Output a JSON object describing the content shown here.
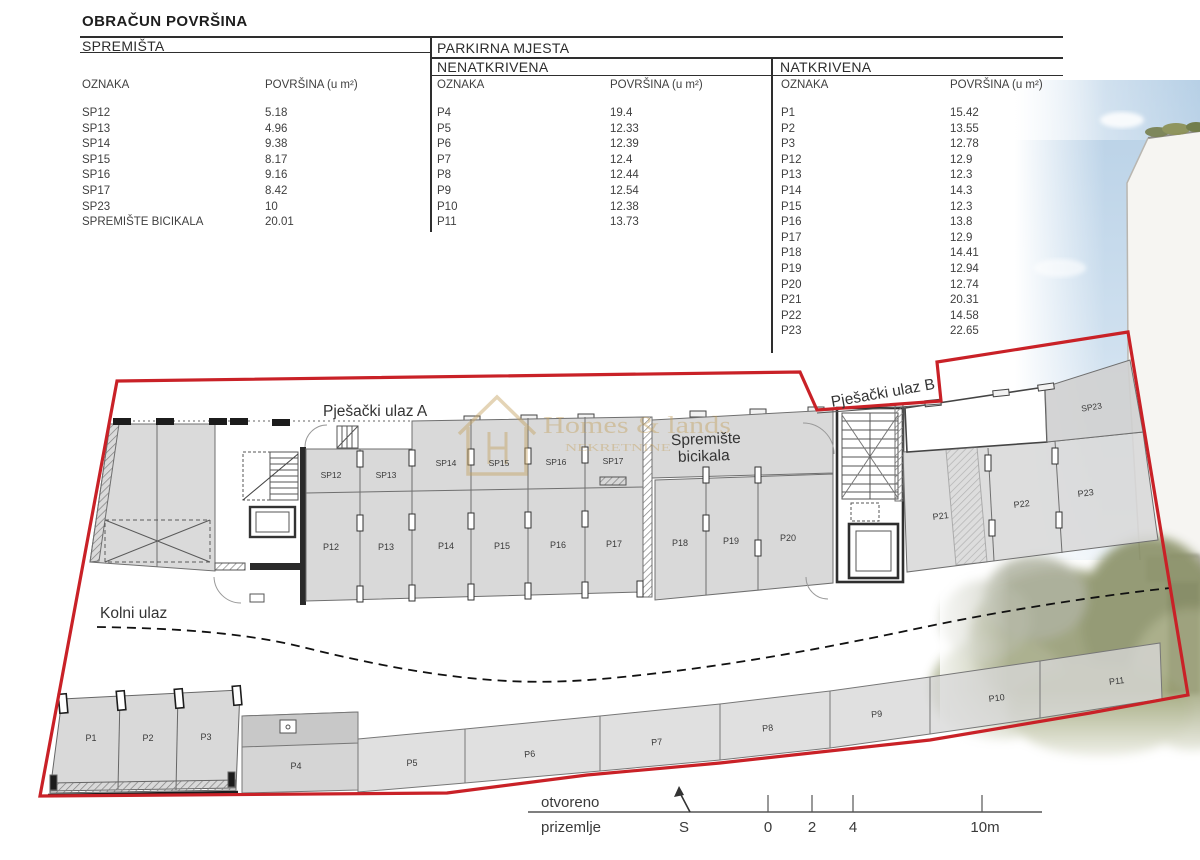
{
  "title": "OBRAČUN POVRŠINA",
  "tables": {
    "spremista": {
      "section_title": "SPREMIŠTA",
      "col_label": "OZNAKA",
      "col_value": "POVRŠINA (u m²)",
      "rows": [
        [
          "SP12",
          "5.18"
        ],
        [
          "SP13",
          "4.96"
        ],
        [
          "SP14",
          "9.38"
        ],
        [
          "SP15",
          "8.17"
        ],
        [
          "SP16",
          "9.16"
        ],
        [
          "SP17",
          "8.42"
        ],
        [
          "SP23",
          "10"
        ],
        [
          "SPREMIŠTE BICIKALA",
          "20.01"
        ]
      ]
    },
    "parkirna": {
      "section_title": "PARKIRNA MJESTA",
      "uncovered": {
        "subtitle": "NENATKRIVENA",
        "col_label": "OZNAKA",
        "col_value": "POVRŠINA (u m²)",
        "rows": [
          [
            "P4",
            "19.4"
          ],
          [
            "P5",
            "12.33"
          ],
          [
            "P6",
            "12.39"
          ],
          [
            "P7",
            "12.4"
          ],
          [
            "P8",
            "12.44"
          ],
          [
            "P9",
            "12.54"
          ],
          [
            "P10",
            "12.38"
          ],
          [
            "P11",
            "13.73"
          ]
        ]
      },
      "covered": {
        "subtitle": "NATKRIVENA",
        "col_label": "OZNAKA",
        "col_value": "POVRŠINA (u m²)",
        "rows": [
          [
            "P1",
            "15.42"
          ],
          [
            "P2",
            "13.55"
          ],
          [
            "P3",
            "12.78"
          ],
          [
            "P12",
            "12.9"
          ],
          [
            "P13",
            "12.3"
          ],
          [
            "P14",
            "14.3"
          ],
          [
            "P15",
            "12.3"
          ],
          [
            "P16",
            "13.8"
          ],
          [
            "P17",
            "12.9"
          ],
          [
            "P18",
            "14.41"
          ],
          [
            "P19",
            "12.94"
          ],
          [
            "P20",
            "12.74"
          ],
          [
            "P21",
            "20.31"
          ],
          [
            "P22",
            "14.58"
          ],
          [
            "P23",
            "22.65"
          ]
        ]
      }
    }
  },
  "plan": {
    "entrance_a": "Pješački ulaz A",
    "entrance_b": "Pješački ulaz B",
    "vehicle_entrance": "Kolni ulaz",
    "bike_room_line1": "Spremište",
    "bike_room_line2": "bicikala",
    "space_labels": [
      {
        "t": "SP12",
        "x": 331,
        "y": 478,
        "s": 8.5
      },
      {
        "t": "SP13",
        "x": 386,
        "y": 478,
        "s": 8.5
      },
      {
        "t": "SP14",
        "x": 446,
        "y": 466,
        "s": 8.5
      },
      {
        "t": "SP15",
        "x": 499,
        "y": 466,
        "s": 8.5
      },
      {
        "t": "SP16",
        "x": 556,
        "y": 465,
        "s": 8.5
      },
      {
        "t": "SP17",
        "x": 613,
        "y": 464,
        "s": 8.5
      },
      {
        "t": "SP23",
        "x": 1092,
        "y": 410,
        "r": -9,
        "s": 8.5
      },
      {
        "t": "P12",
        "x": 331,
        "y": 550
      },
      {
        "t": "P13",
        "x": 386,
        "y": 550
      },
      {
        "t": "P14",
        "x": 446,
        "y": 549
      },
      {
        "t": "P15",
        "x": 502,
        "y": 549
      },
      {
        "t": "P16",
        "x": 558,
        "y": 548
      },
      {
        "t": "P17",
        "x": 614,
        "y": 547
      },
      {
        "t": "P18",
        "x": 680,
        "y": 546
      },
      {
        "t": "P19",
        "x": 731,
        "y": 544
      },
      {
        "t": "P20",
        "x": 788,
        "y": 541
      },
      {
        "t": "P21",
        "x": 941,
        "y": 519,
        "r": -7
      },
      {
        "t": "P22",
        "x": 1022,
        "y": 507,
        "r": -7
      },
      {
        "t": "P23",
        "x": 1086,
        "y": 496,
        "r": -7
      },
      {
        "t": "P1",
        "x": 91,
        "y": 741
      },
      {
        "t": "P2",
        "x": 148,
        "y": 741
      },
      {
        "t": "P3",
        "x": 206,
        "y": 740
      },
      {
        "t": "P4",
        "x": 296,
        "y": 769
      },
      {
        "t": "P5",
        "x": 412,
        "y": 766
      },
      {
        "t": "P6",
        "x": 530,
        "y": 757,
        "r": -5
      },
      {
        "t": "P7",
        "x": 657,
        "y": 745,
        "r": -5
      },
      {
        "t": "P8",
        "x": 768,
        "y": 731,
        "r": -6
      },
      {
        "t": "P9",
        "x": 877,
        "y": 717,
        "r": -6
      },
      {
        "t": "P10",
        "x": 997,
        "y": 701,
        "r": -7
      },
      {
        "t": "P11",
        "x": 1117,
        "y": 684,
        "r": -7
      }
    ]
  },
  "watermark": {
    "brand": "Homes & lands",
    "subtitle": "NEKRETNINE"
  },
  "legend": {
    "floor_top": "otvoreno",
    "floor_bottom": "prizemlje",
    "north_label": "S",
    "scale_ticks": [
      "0",
      "2",
      "4",
      "10m"
    ]
  },
  "colors": {
    "boundary_red": "#c92127",
    "plan_fill": "#d9d9d9",
    "watermark_gold": "#c5a260"
  }
}
